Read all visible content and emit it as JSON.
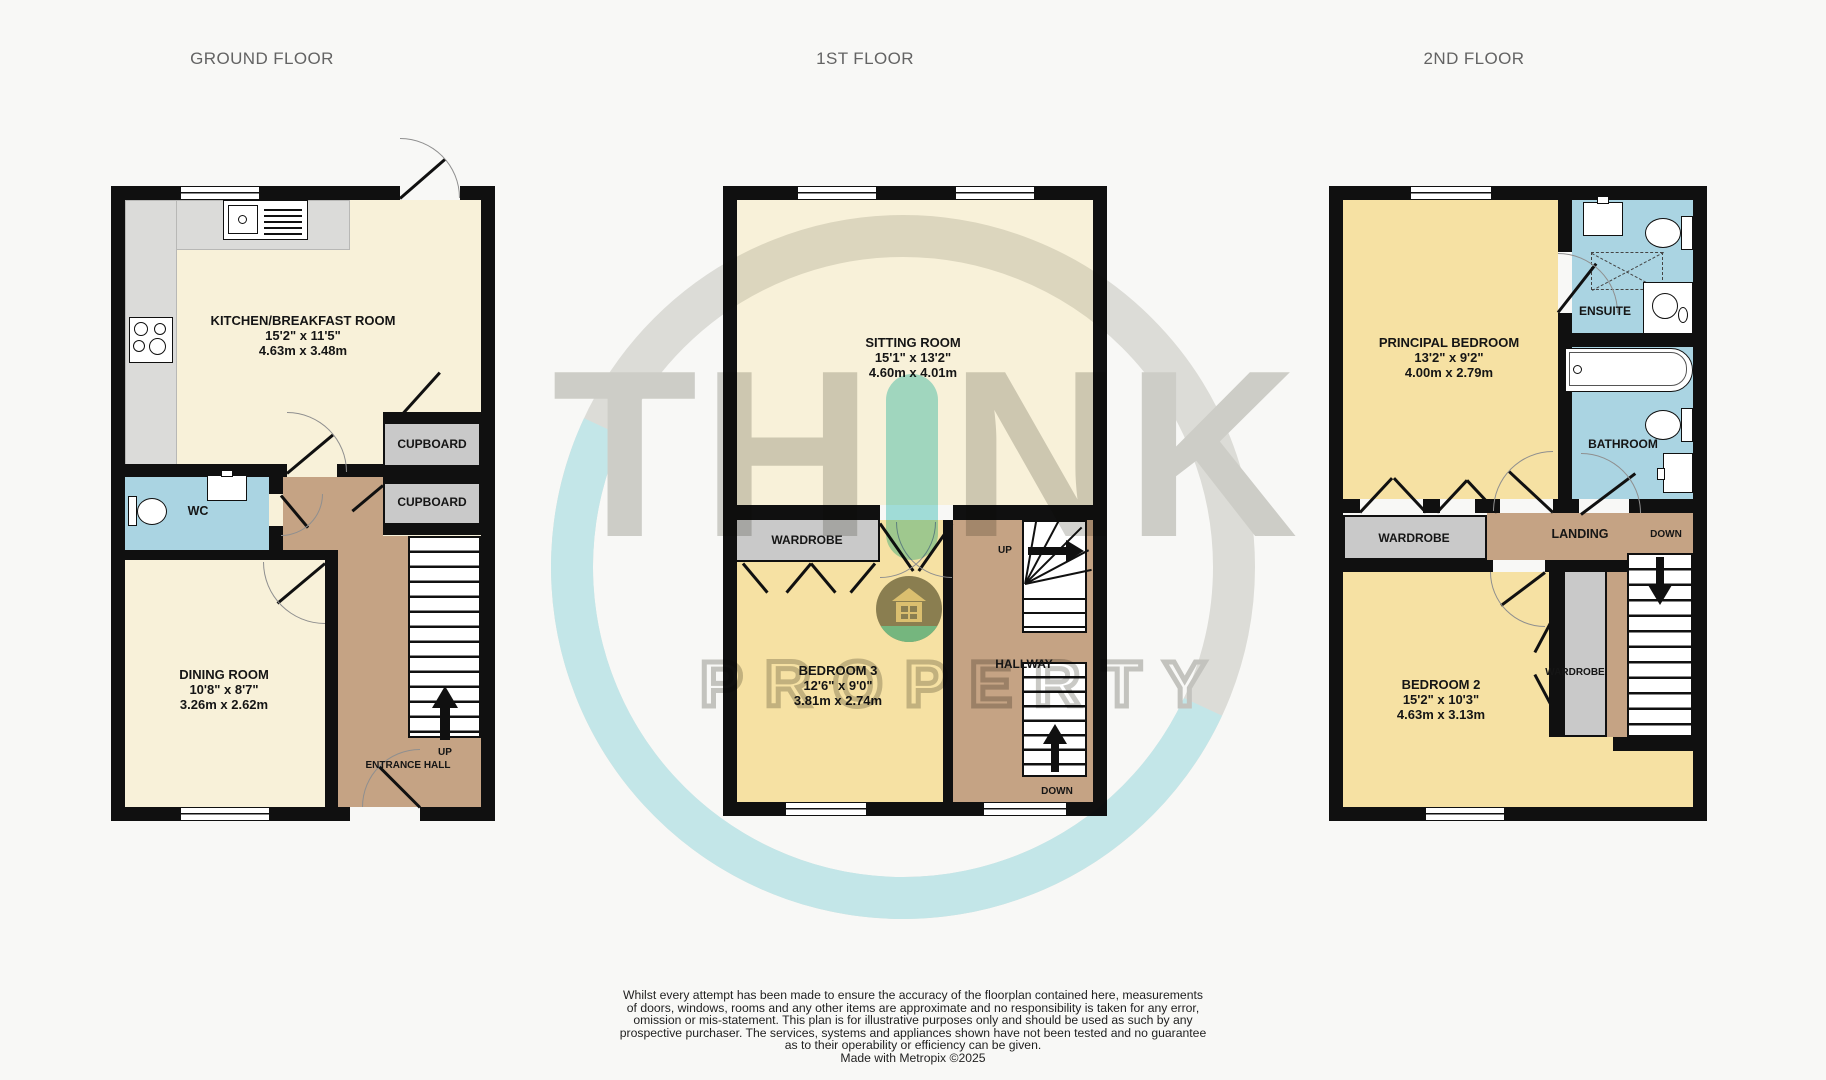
{
  "titles": {
    "ground": "GROUND FLOOR",
    "first": "1ST FLOOR",
    "second": "2ND FLOOR"
  },
  "colors": {
    "cream": "#f8f1d9",
    "bedroom_yellow": "#f6e1a3",
    "wet_blue": "#aad4e2",
    "hall_brown": "#c5a384",
    "counter_gray": "#dbdbd9",
    "wall": "#101010",
    "watermark_gray": "#d3d3cf",
    "watermark_teal": "#a5e3df"
  },
  "ground_floor": {
    "kitchen": {
      "name": "KITCHEN/BREAKFAST ROOM",
      "imperial": "15'2\"  x 11'5\"",
      "metric": "4.63m  x 3.48m"
    },
    "dining": {
      "name": "DINING ROOM",
      "imperial": "10'8\"  x 8'7\"",
      "metric": "3.26m  x 2.62m"
    },
    "wc": "WC",
    "cupboard1": "CUPBOARD",
    "cupboard2": "CUPBOARD",
    "up": "UP",
    "entrance_hall": "ENTRANCE HALL"
  },
  "first_floor": {
    "sitting": {
      "name": "SITTING ROOM",
      "imperial": "15'1\"  x 13'2\"",
      "metric": "4.60m  x 4.01m"
    },
    "bedroom3": {
      "name": "BEDROOM 3",
      "imperial": "12'6\"  x 9'0\"",
      "metric": "3.81m  x 2.74m"
    },
    "wardrobe": "WARDROBE",
    "hallway": "HALLWAY",
    "up": "UP",
    "down": "DOWN"
  },
  "second_floor": {
    "principal": {
      "name": "PRINCIPAL BEDROOM",
      "imperial": "13'2\"  x 9'2\"",
      "metric": "4.00m  x 2.79m"
    },
    "bedroom2": {
      "name": "BEDROOM 2",
      "imperial": "15'2\"  x 10'3\"",
      "metric": "4.63m  x 3.13m"
    },
    "ensuite": "ENSUITE",
    "bathroom": "BATHROOM",
    "wardrobe": "WARDROBE",
    "wardrobe2": "WARDROBE",
    "landing": "LANDING",
    "down": "DOWN"
  },
  "watermark": {
    "brand_left": "TH",
    "brand_right": "NK",
    "brand_bottom": "PROPERTY"
  },
  "disclaimer": {
    "line1": "Whilst every attempt has been made to ensure the accuracy of the floorplan contained here, measurements",
    "line2": "of doors, windows, rooms and any other items are approximate and no responsibility is taken for any error,",
    "line3": "omission or mis-statement. This plan is for illustrative purposes only and should be used as such by any",
    "line4": "prospective purchaser. The services, systems and appliances shown have not been tested and no guarantee",
    "line5": "as to their operability or efficiency can be given.",
    "credit": "Made with Metropix ©2025"
  }
}
